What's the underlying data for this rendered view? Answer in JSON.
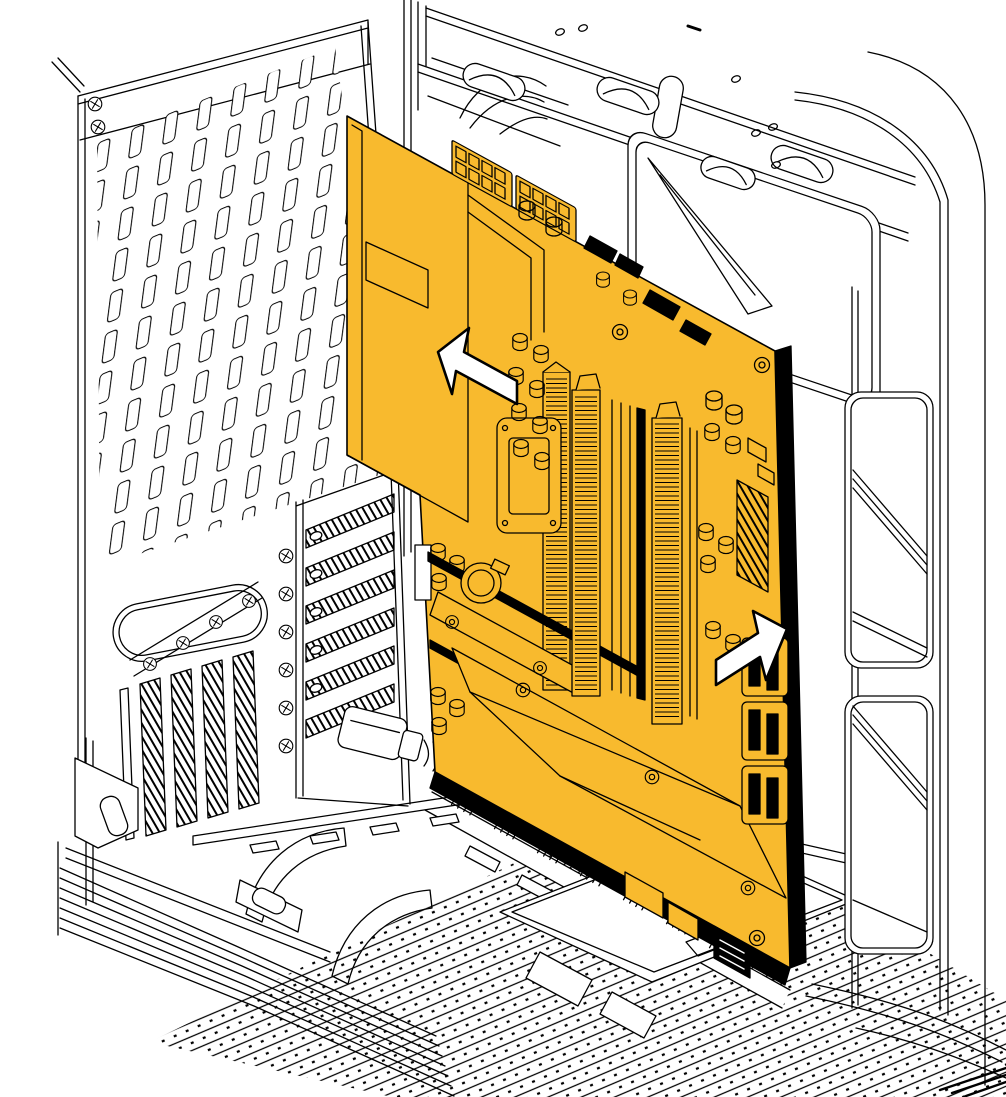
{
  "meta": {
    "type": "technical-illustration",
    "subject": "Motherboard assembly installation into tower PC chassis",
    "view": "isometric black line art on white, highlighted component in orange"
  },
  "colors": {
    "background": "#ffffff",
    "line": "#000000",
    "highlight": "#F8BA2E",
    "arrow_fill": "#ffffff"
  },
  "highlighted_component": {
    "name": "motherboard-assembly",
    "parts": [
      "io-shroud",
      "eps-power-connectors",
      "vrm-heatsink-fins",
      "cpu-socket",
      "ram-modules",
      "cmos-battery",
      "pcie-slots",
      "m2-heatsink-plate",
      "chipset-heatsink-plate",
      "atx-24pin-connector",
      "sata-usb-port-stack",
      "front-panel-headers",
      "capacitor-clusters",
      "standoff-screws"
    ]
  },
  "case_parts": [
    "rear-vent-panel",
    "rear-panel-screws",
    "io-stadium-cutout",
    "vertical-vent-slots",
    "pci-slot-covers",
    "pci-thumbscrews",
    "top-frame-beams",
    "radiator-bracket",
    "cooling-fan",
    "right-pillar",
    "pillar-rib-panels",
    "bottom-vent-floor",
    "cable-tray-bridges",
    "cable-cover-bracket",
    "psu-cable-plug",
    "front-corner-panel"
  ],
  "annotations": {
    "arrows": [
      {
        "direction": "up-left",
        "meaning": "push board toward rear I/O panel"
      },
      {
        "direction": "up-right",
        "meaning": "seat right edge onto standoffs"
      }
    ]
  }
}
